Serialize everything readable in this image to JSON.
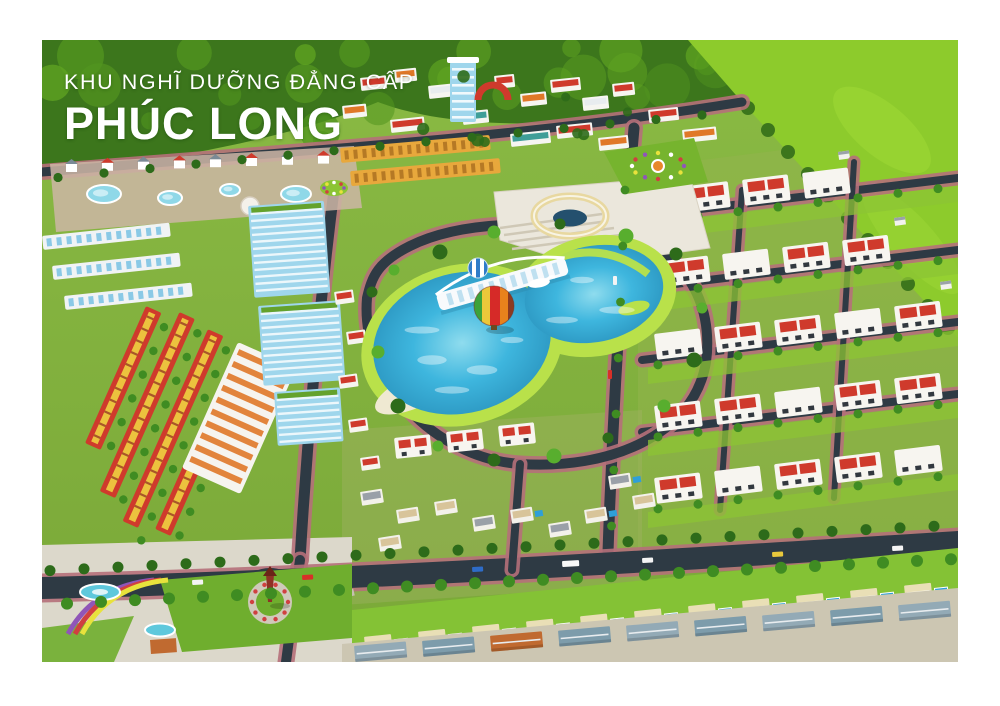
{
  "poster": {
    "title_line1": "KHU NGHĨ DƯỠNG ĐẲNG CẤP",
    "title_line2": "PHÚC LONG"
  },
  "palette": {
    "frame_white": "#ffffff",
    "forest_dark": "#3c761c",
    "forest_mid": "#52961f",
    "field_bright": "#8dcb2c",
    "grass_top": "#8aba44",
    "grass_bottom": "#7aa838",
    "grass_bright": "#8cc434",
    "road": "#2e3a44",
    "sidewalk_pink": "#b5707a",
    "roof_red": "#cf3a2c",
    "roof_orange": "#e07828",
    "roof_beige": "#d8c49a",
    "facade_yellow": "#ecc23e",
    "wall_white": "#f6f4ef",
    "building_blue": "#9fd6ec",
    "lake_water": "#3eb6de",
    "lake_light": "#8fdcee",
    "shore_green": "#b9e14a",
    "sand": "#efe9d2",
    "bridge_white": "#f8fafc",
    "balloon_red": "#d62a28",
    "balloon_orange": "#e8821c",
    "balloon_yellow": "#ecc83a",
    "balloon_green": "#3ca23a",
    "pool_blue": "#2f9fd8",
    "plaza_cream": "#ebe7dc",
    "flower_purple": "#9055b8",
    "flower_red": "#d04040",
    "tree_dark": "#2d6b1a",
    "tree_mid": "#3f8c22",
    "palm_green": "#58ae2e",
    "monument_red": "#8e3226",
    "village_ground": "#ccc6b2",
    "water_pond": "#8fd8e8"
  }
}
